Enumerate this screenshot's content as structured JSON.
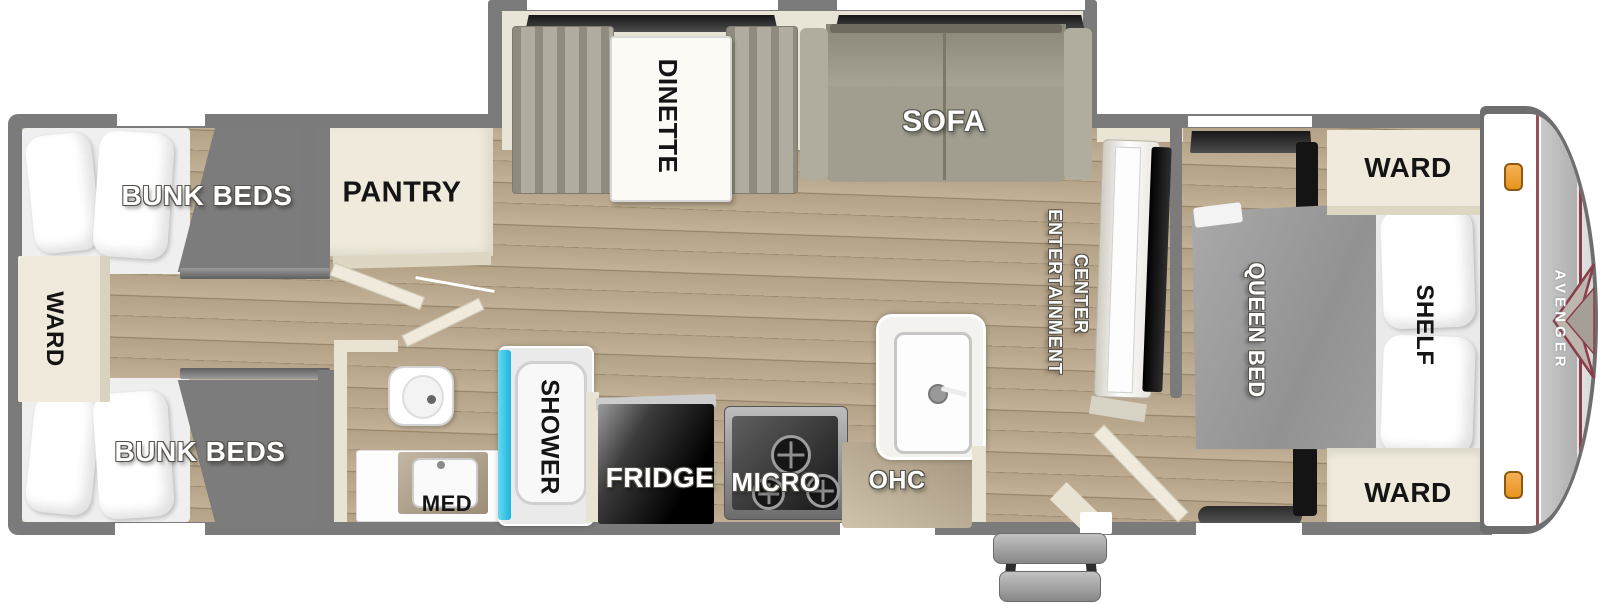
{
  "meta": {
    "title": "Avenger travel trailer floor plan",
    "view": "top-down floorplan"
  },
  "brand": {
    "logo_text": "AVENGER"
  },
  "colors": {
    "wall_gray": "#7b7b7b",
    "floor_wood_light": "#bcab90",
    "floor_wood_dark": "#8e7d61",
    "cabinet_cream": "#efeadb",
    "slideout_cream": "#e9e5d6",
    "sofa_gray": "#9c9889",
    "bunk_mattress_gray": "#7c7c7c",
    "queen_bed_gray": "#9e9e9e",
    "shower_cyan": "#2fc0e6",
    "marker_light_orange": "#f2a13c",
    "accent_maroon": "#8a3e48",
    "appliance_black": "#111111",
    "counter_tan": "#b3a58c"
  },
  "labels": {
    "rear_ward": "WARD",
    "bunk_top": "BUNK BEDS",
    "bunk_bottom": "BUNK BEDS",
    "pantry": "PANTRY",
    "dinette": "DINETTE",
    "sofa": "SOFA",
    "entertainment_line1": "ENTERTAINMENT",
    "entertainment_line2": "CENTER",
    "shower": "SHOWER",
    "med": "MED",
    "fridge": "FRIDGE",
    "micro": "MICRO",
    "ohc": "OHC",
    "queen_bed": "QUEEN BED",
    "shelf": "SHELF",
    "front_ward_top": "WARD",
    "front_ward_bottom": "WARD"
  }
}
